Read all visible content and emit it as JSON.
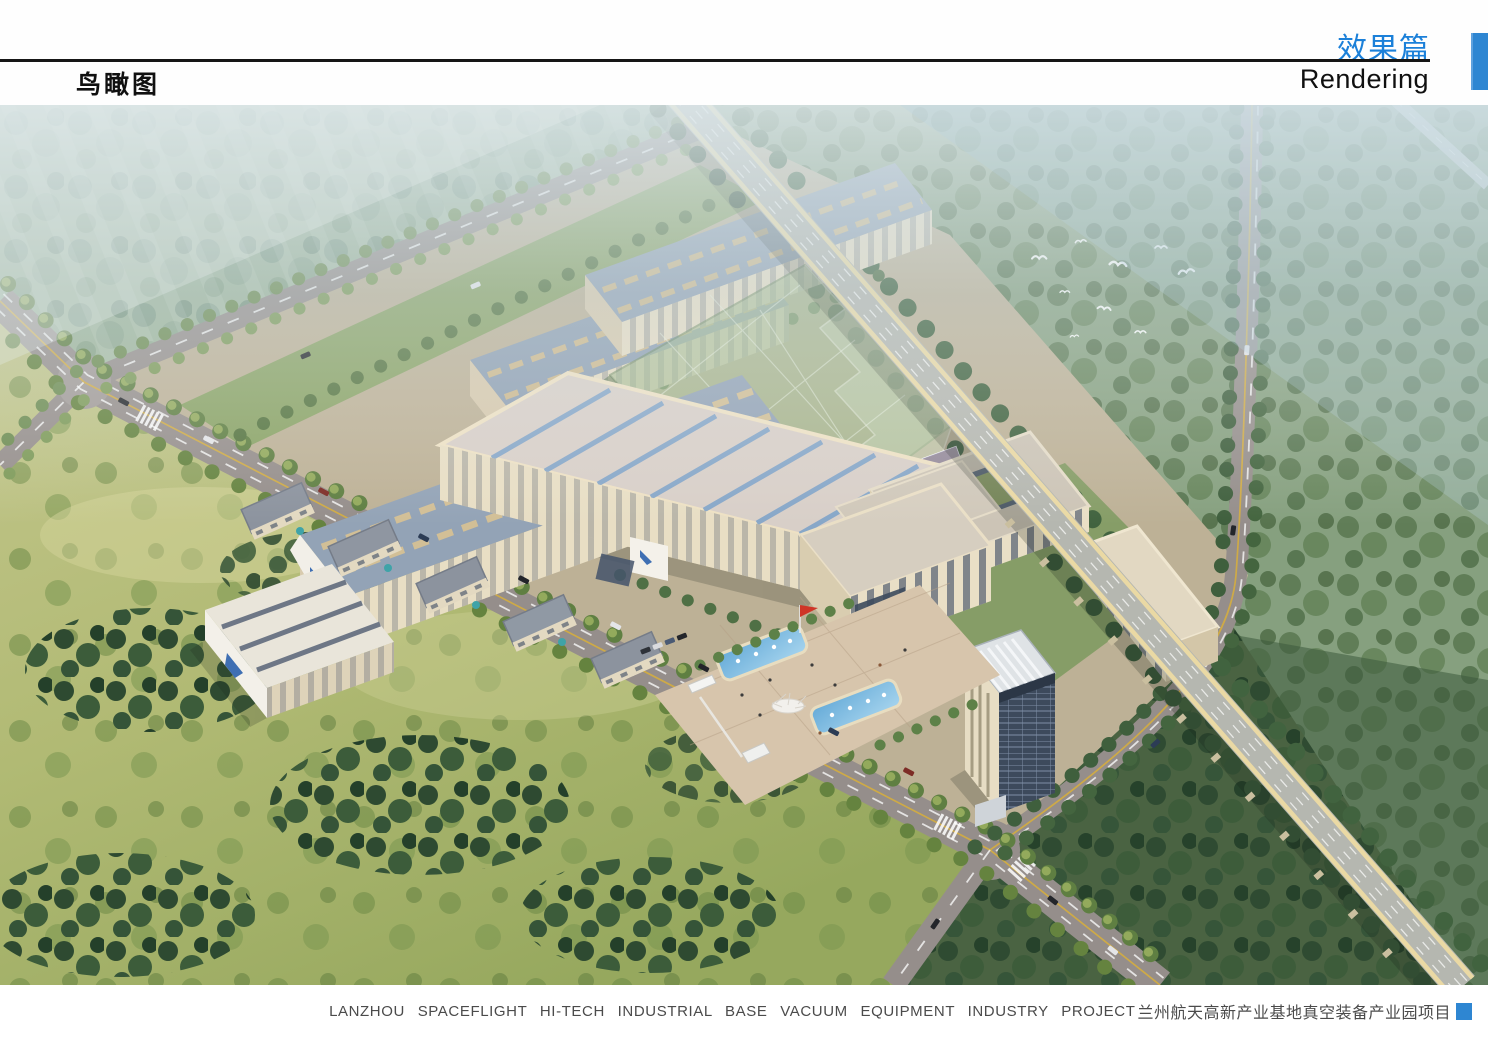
{
  "header": {
    "section_title_zh": "效果篇",
    "section_title_en": "Rendering",
    "page_title": "鸟瞰图"
  },
  "footer": {
    "caption_en": "LANZHOU SPACEFLIGHT HI-TECH INDUSTRIAL BASE VACUUM EQUIPMENT INDUSTRY PROJECT",
    "caption_zh": "兰州航天高新产业基地真空装备产业园项目"
  },
  "colors": {
    "accent_blue": "#2E86D2",
    "header_title_blue": "#1B80D9",
    "rule_black": "#161616",
    "caption_gray": "#4B4B4B"
  }
}
